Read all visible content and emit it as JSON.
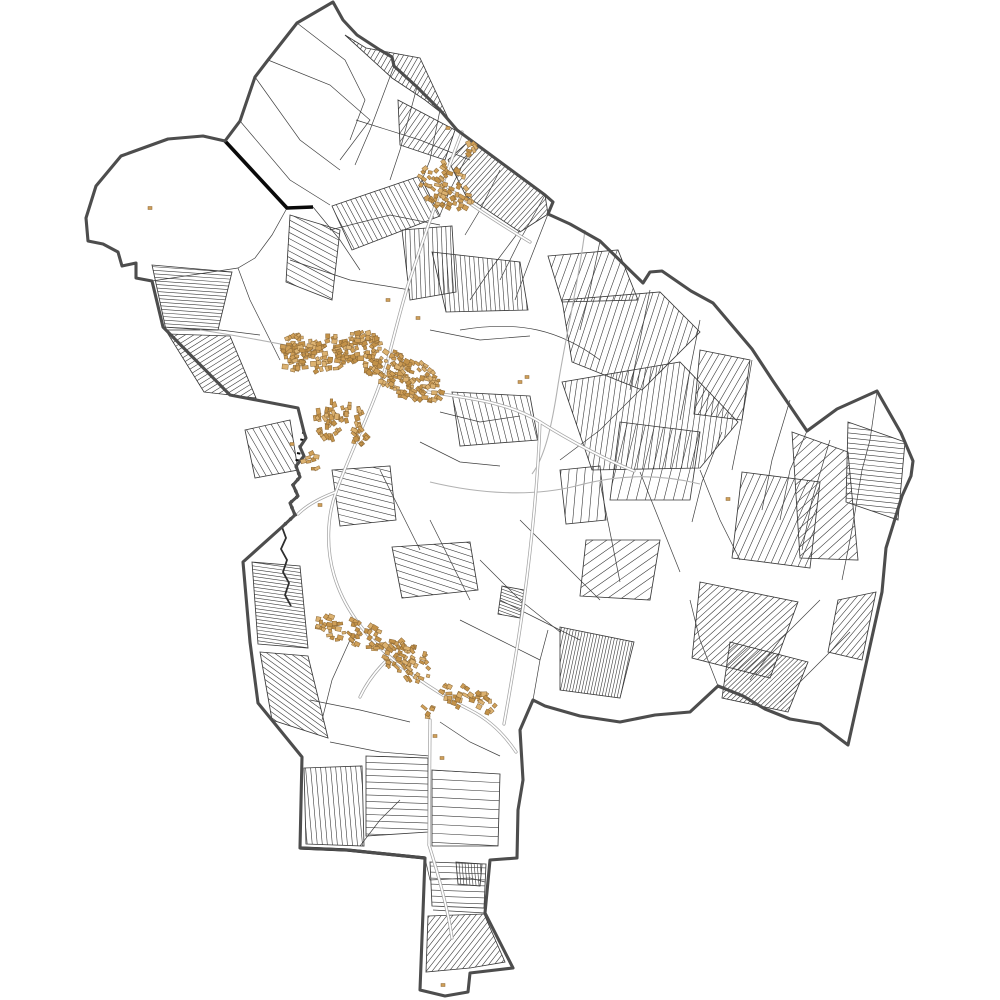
{
  "meta": {
    "title": "cadastral-commune-map",
    "background": "#ffffff",
    "width": 1000,
    "height": 1000
  },
  "palette": {
    "parcel_line": "#3a3a3a",
    "mesh_line": "#404040",
    "boundary": "#4d4d4d",
    "boundary_black": "#0a0a0a",
    "road_casing": "#a5a5a5",
    "road_fill": "#ffffff",
    "stream": "#b2b2b2",
    "river": "#2e2e2e",
    "building_fills": [
      "#cf9f58",
      "#c29148",
      "#dcb271"
    ],
    "building_stroke": "#8a6736"
  },
  "seed": 1337,
  "boundary": {
    "width": 3.1,
    "path": "M333,2 L343,20 L357,35 L380,50 L392,57 L394,66 L417,87 L440,110 L457,130 L545,195 L553,202 L548,214 L570,224 L600,241 L643,283 L650,272 L662,271 L691,291 L713,303 L752,349 L773,381 L807,431 L837,409 L877,391 L901,433 L913,461 L911,476 L902,496 L886,548 L882,592 L848,745 L820,724 L790,719 L765,709 L743,696 L718,686 L690,712 L655,715 L620,722 L580,716 L545,706 L533,700 L520,730 L523,780 L518,810 L517,858 L490,860 L485,913 L513,968 L470,973 L468,992 L445,996 L420,990 L423,912 L425,858 L347,850 L300,848 L302,757 L258,703 L250,642 L243,562 L282,527 L295,515 L290,503 L298,496 L293,485 L300,477 L296,466 L304,456 L300,447 L306,438 L304,432 L298,408 L230,395 L163,327 L152,281 L136,278 L136,263 L122,266 L118,252 L103,244 L88,241 L86,218 L96,186 L121,156 L168,139 L203,136 L225,141 L240,121 L255,77 L268,60 L297,23 Z"
  },
  "black_segments": [
    {
      "path": "M225,141 L287,208 L313,207",
      "width": 3.6
    },
    {
      "path": "M300,848 L347,850 L425,858",
      "width": 3.2
    }
  ],
  "river": {
    "path": "M282,527 L286,538 L281,549 L287,560 L283,572 L289,583 L285,595 L291,606",
    "width": 1.8,
    "dash_path": "M304,432 L300,447 L296,466 L300,477 L293,485 L298,496 L290,503 L295,515 L282,527",
    "dash": "2 5"
  },
  "streams": [
    "M585,230 C578,285 566,335 558,385 C552,425 545,457 532,474",
    "M430,482 C480,494 532,497 576,486 C620,474 660,474 700,484",
    "M200,330 C240,336 270,342 296,347"
  ],
  "roads": [
    "M462,132 C445,175 425,235 408,285 C398,318 392,345 386,366",
    "M446,186 C472,206 500,224 530,242",
    "M386,366 C372,410 352,448 336,492 C327,517 326,548 334,575 C343,606 362,632 390,657 C412,676 442,696 470,710 C488,719 504,734 516,752",
    "M428,392 C468,398 508,402 540,422 C572,442 602,458 634,471",
    "M540,422 C538,480 532,540 524,600 C518,646 510,690 504,724",
    "M430,720 C430,760 429,800 429,845",
    "M429,845 C440,880 448,910 452,938",
    "M390,657 C376,670 366,684 360,697",
    "M336,492 C320,498 306,506 298,514"
  ],
  "mesh_paths": [
    "M297,23 L345,60 L365,100 L350,140",
    "M268,60 L330,85 L370,120 L340,160",
    "M255,77 L300,140 L340,170",
    "M240,121 L290,180 L330,205",
    "M394,66 L370,130 L355,165",
    "M417,87 L400,150 L390,180",
    "M440,110 L430,160 L418,190",
    "M470,150 L450,190 L440,215",
    "M500,170 L480,210 L465,235",
    "M520,230 L490,270 L470,300",
    "M548,214 L530,260 L515,300",
    "M330,230 L390,215 L440,225",
    "M290,260 L350,280 L410,290",
    "M430,330 L480,340 L530,336",
    "M440,412 L480,422 L520,416",
    "M420,442 L460,462 L500,466",
    "M600,241 L590,290 L580,330",
    "M650,290 L640,340 L630,390",
    "M700,320 L690,370 L680,420",
    "M722,432 L702,482 L692,522",
    "M752,360 L742,420 L732,470",
    "M790,400 L772,460 L762,510",
    "M830,440 L812,500 L802,550",
    "M862,470 L852,530 L842,580",
    "M700,470 L720,520 L740,560",
    "M640,472 L660,522 L680,572",
    "M600,482 L610,532 L620,582",
    "M520,520 L560,560 L600,600",
    "M480,560 L520,600 L560,632",
    "M430,520 L450,560 L470,600",
    "M380,470 L400,510 L420,550",
    "M820,600 L780,640 L750,680",
    "M850,632 L810,672 L780,702",
    "M310,700 L360,710 L410,722",
    "M330,742 L380,752 L430,756",
    "M350,640 L332,680 L322,720",
    "M440,722 L470,742 L500,756",
    "M460,620 L500,640 L540,660",
    "M500,600 L540,620 L580,640",
    "M360,846 L380,820 L400,800",
    "M287,208 L272,235 L255,258 L238,268 L152,281",
    "M238,268 L250,300 L265,330 L280,360",
    "M163,327 L220,330 L260,335",
    "M545,195 L520,240 L500,280",
    "M313,207 L340,240 L360,270",
    "M460,330 C520,320 560,330 600,360",
    "M356,120 L420,140 L470,160",
    "M640,390 L600,430 L560,460",
    "M807,431 L790,470 L780,520",
    "M877,391 L870,440 L862,470",
    "M718,686 L700,640 L690,600",
    "M533,700 L540,660 L548,630",
    "M425,858 L430,880 L470,878 L485,882",
    "M433,910 L485,913"
  ],
  "hatch_blocks": [
    {
      "poly": [
        [
          345,
          35
        ],
        [
          392,
          78
        ],
        [
          425,
          100
        ],
        [
          448,
          118
        ],
        [
          420,
          58
        ],
        [
          366,
          48
        ]
      ],
      "angle": -60,
      "gap": 4.5
    },
    {
      "poly": [
        [
          470,
          140
        ],
        [
          545,
          195
        ],
        [
          548,
          214
        ],
        [
          520,
          232
        ],
        [
          466,
          196
        ],
        [
          448,
          160
        ]
      ],
      "angle": -48,
      "gap": 4
    },
    {
      "poly": [
        [
          398,
          100
        ],
        [
          455,
          130
        ],
        [
          445,
          160
        ],
        [
          400,
          145
        ]
      ],
      "angle": -55,
      "gap": 5
    },
    {
      "poly": [
        [
          402,
          230
        ],
        [
          452,
          226
        ],
        [
          456,
          292
        ],
        [
          410,
          300
        ]
      ],
      "angle": 88,
      "gap": 4.5
    },
    {
      "poly": [
        [
          290,
          215
        ],
        [
          340,
          230
        ],
        [
          332,
          300
        ],
        [
          286,
          282
        ]
      ],
      "angle": 28,
      "gap": 5.5
    },
    {
      "poly": [
        [
          152,
          265
        ],
        [
          232,
          272
        ],
        [
          218,
          330
        ],
        [
          166,
          330
        ]
      ],
      "angle": 4,
      "gap": 3.5
    },
    {
      "poly": [
        [
          168,
          334
        ],
        [
          230,
          336
        ],
        [
          256,
          398
        ],
        [
          204,
          392
        ]
      ],
      "angle": -32,
      "gap": 4.5
    },
    {
      "poly": [
        [
          332,
          206
        ],
        [
          420,
          176
        ],
        [
          440,
          216
        ],
        [
          352,
          250
        ]
      ],
      "angle": 62,
      "gap": 5
    },
    {
      "poly": [
        [
          432,
          252
        ],
        [
          520,
          262
        ],
        [
          528,
          310
        ],
        [
          446,
          312
        ]
      ],
      "angle": 86,
      "gap": 4.5
    },
    {
      "poly": [
        [
          562,
          300
        ],
        [
          660,
          292
        ],
        [
          700,
          332
        ],
        [
          642,
          390
        ],
        [
          572,
          362
        ]
      ],
      "angle": -72,
      "gap": 6
    },
    {
      "poly": [
        [
          562,
          382
        ],
        [
          680,
          362
        ],
        [
          738,
          422
        ],
        [
          700,
          468
        ],
        [
          592,
          470
        ]
      ],
      "angle": -82,
      "gap": 5.5
    },
    {
      "poly": [
        [
          848,
          422
        ],
        [
          905,
          442
        ],
        [
          898,
          520
        ],
        [
          846,
          502
        ]
      ],
      "angle": 6,
      "gap": 5
    },
    {
      "poly": [
        [
          792,
          432
        ],
        [
          848,
          452
        ],
        [
          858,
          560
        ],
        [
          800,
          558
        ]
      ],
      "angle": -42,
      "gap": 7
    },
    {
      "poly": [
        [
          742,
          472
        ],
        [
          820,
          482
        ],
        [
          810,
          568
        ],
        [
          732,
          558
        ]
      ],
      "angle": -66,
      "gap": 6.5
    },
    {
      "poly": [
        [
          700,
          582
        ],
        [
          798,
          602
        ],
        [
          770,
          678
        ],
        [
          692,
          658
        ]
      ],
      "angle": -42,
      "gap": 5
    },
    {
      "poly": [
        [
          730,
          642
        ],
        [
          808,
          662
        ],
        [
          788,
          712
        ],
        [
          722,
          698
        ]
      ],
      "angle": -44,
      "gap": 3.5
    },
    {
      "poly": [
        [
          560,
          627
        ],
        [
          634,
          642
        ],
        [
          620,
          698
        ],
        [
          560,
          690
        ]
      ],
      "angle": -78,
      "gap": 3
    },
    {
      "poly": [
        [
          392,
          547
        ],
        [
          470,
          542
        ],
        [
          478,
          590
        ],
        [
          402,
          598
        ]
      ],
      "angle": 18,
      "gap": 6
    },
    {
      "poly": [
        [
          252,
          562
        ],
        [
          300,
          566
        ],
        [
          308,
          648
        ],
        [
          258,
          644
        ]
      ],
      "angle": 8,
      "gap": 3.5
    },
    {
      "poly": [
        [
          260,
          652
        ],
        [
          308,
          656
        ],
        [
          328,
          738
        ],
        [
          272,
          720
        ]
      ],
      "angle": 36,
      "gap": 4.5
    },
    {
      "poly": [
        [
          304,
          768
        ],
        [
          362,
          766
        ],
        [
          364,
          846
        ],
        [
          306,
          844
        ]
      ],
      "angle": 85,
      "gap": 5
    },
    {
      "poly": [
        [
          366,
          756
        ],
        [
          428,
          758
        ],
        [
          428,
          832
        ],
        [
          366,
          836
        ]
      ],
      "angle": 2,
      "gap": 6.5
    },
    {
      "poly": [
        [
          432,
          770
        ],
        [
          500,
          774
        ],
        [
          498,
          846
        ],
        [
          432,
          846
        ]
      ],
      "angle": 3,
      "gap": 9
    },
    {
      "poly": [
        [
          428,
          916
        ],
        [
          484,
          914
        ],
        [
          505,
          962
        ],
        [
          470,
          968
        ],
        [
          426,
          972
        ]
      ],
      "angle": -52,
      "gap": 4.5
    },
    {
      "poly": [
        [
          430,
          862
        ],
        [
          486,
          864
        ],
        [
          484,
          908
        ],
        [
          432,
          906
        ]
      ],
      "angle": 2,
      "gap": 6
    },
    {
      "poly": [
        [
          456,
          862
        ],
        [
          482,
          864
        ],
        [
          480,
          886
        ],
        [
          458,
          884
        ]
      ],
      "angle": 85,
      "gap": 3
    },
    {
      "poly": [
        [
          452,
          392
        ],
        [
          530,
          396
        ],
        [
          538,
          440
        ],
        [
          460,
          446
        ]
      ],
      "angle": 76,
      "gap": 6
    },
    {
      "poly": [
        [
          332,
          470
        ],
        [
          390,
          466
        ],
        [
          396,
          520
        ],
        [
          340,
          526
        ]
      ],
      "angle": 14,
      "gap": 6
    },
    {
      "poly": [
        [
          620,
          422
        ],
        [
          700,
          432
        ],
        [
          690,
          500
        ],
        [
          610,
          500
        ]
      ],
      "angle": -76,
      "gap": 9
    },
    {
      "poly": [
        [
          548,
          256
        ],
        [
          618,
          250
        ],
        [
          638,
          300
        ],
        [
          562,
          302
        ]
      ],
      "angle": -70,
      "gap": 7
    },
    {
      "poly": [
        [
          502,
          586
        ],
        [
          524,
          590
        ],
        [
          520,
          618
        ],
        [
          498,
          614
        ]
      ],
      "angle": 20,
      "gap": 3
    },
    {
      "poly": [
        [
          560,
          470
        ],
        [
          600,
          466
        ],
        [
          606,
          520
        ],
        [
          566,
          524
        ]
      ],
      "angle": -85,
      "gap": 8
    },
    {
      "poly": [
        [
          245,
          430
        ],
        [
          290,
          420
        ],
        [
          298,
          470
        ],
        [
          255,
          478
        ]
      ],
      "angle": 60,
      "gap": 6
    },
    {
      "poly": [
        [
          700,
          350
        ],
        [
          750,
          360
        ],
        [
          742,
          420
        ],
        [
          694,
          414
        ]
      ],
      "angle": -60,
      "gap": 6
    },
    {
      "poly": [
        [
          586,
          540
        ],
        [
          660,
          540
        ],
        [
          650,
          600
        ],
        [
          580,
          596
        ]
      ],
      "angle": -35,
      "gap": 8
    },
    {
      "poly": [
        [
          838,
          600
        ],
        [
          876,
          592
        ],
        [
          862,
          660
        ],
        [
          828,
          652
        ]
      ],
      "angle": -50,
      "gap": 5
    }
  ],
  "building_clusters": [
    {
      "cx": 332,
      "cy": 352,
      "rx": 52,
      "ry": 17,
      "rot": -12,
      "n": 150
    },
    {
      "cx": 402,
      "cy": 374,
      "rx": 46,
      "ry": 20,
      "rot": 28,
      "n": 150
    },
    {
      "cx": 338,
      "cy": 420,
      "rx": 20,
      "ry": 26,
      "rot": 75,
      "n": 55
    },
    {
      "cx": 296,
      "cy": 347,
      "rx": 17,
      "ry": 12,
      "rot": -20,
      "n": 35
    },
    {
      "cx": 446,
      "cy": 186,
      "rx": 30,
      "ry": 22,
      "rot": 35,
      "n": 70
    },
    {
      "cx": 352,
      "cy": 632,
      "rx": 38,
      "ry": 13,
      "rot": 18,
      "n": 55
    },
    {
      "cx": 408,
      "cy": 662,
      "rx": 28,
      "ry": 17,
      "rot": 35,
      "n": 65
    },
    {
      "cx": 468,
      "cy": 698,
      "rx": 30,
      "ry": 13,
      "rot": 22,
      "n": 40
    },
    {
      "cx": 310,
      "cy": 462,
      "rx": 10,
      "ry": 9,
      "rot": 0,
      "n": 8
    },
    {
      "cx": 360,
      "cy": 438,
      "rx": 12,
      "ry": 10,
      "rot": 40,
      "n": 14
    },
    {
      "cx": 470,
      "cy": 148,
      "rx": 8,
      "ry": 7,
      "rot": 40,
      "n": 6
    },
    {
      "cx": 430,
      "cy": 712,
      "rx": 10,
      "ry": 7,
      "rot": 20,
      "n": 6
    }
  ],
  "building_singles": [
    [
      150,
      208
    ],
    [
      728,
      499
    ],
    [
      520,
      382
    ],
    [
      527,
      377
    ],
    [
      435,
      736
    ],
    [
      442,
      758
    ],
    [
      320,
      505
    ],
    [
      292,
      444
    ],
    [
      448,
      128
    ],
    [
      388,
      300
    ],
    [
      418,
      318
    ],
    [
      443,
      985
    ]
  ]
}
